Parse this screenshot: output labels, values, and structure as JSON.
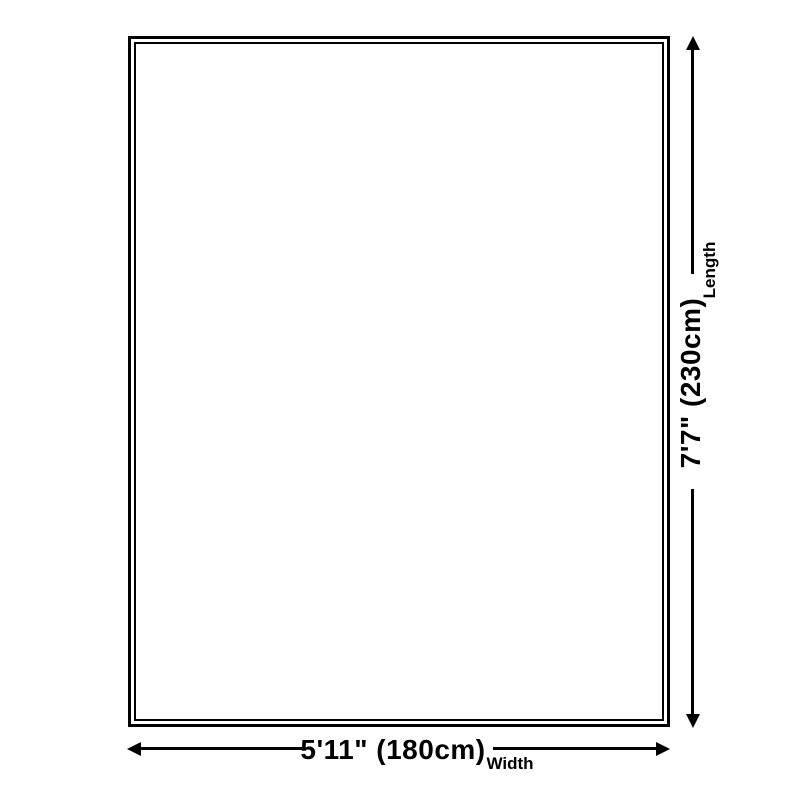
{
  "diagram": {
    "colors": {
      "background": "#ffffff",
      "line": "#000000",
      "text": "#000000"
    },
    "rug": {
      "border_style": "double-outline"
    },
    "length_dimension": {
      "value": "7'7\" (230cm)",
      "label": "Length"
    },
    "width_dimension": {
      "value": "5'11\" (180cm)",
      "label": "Width"
    }
  }
}
